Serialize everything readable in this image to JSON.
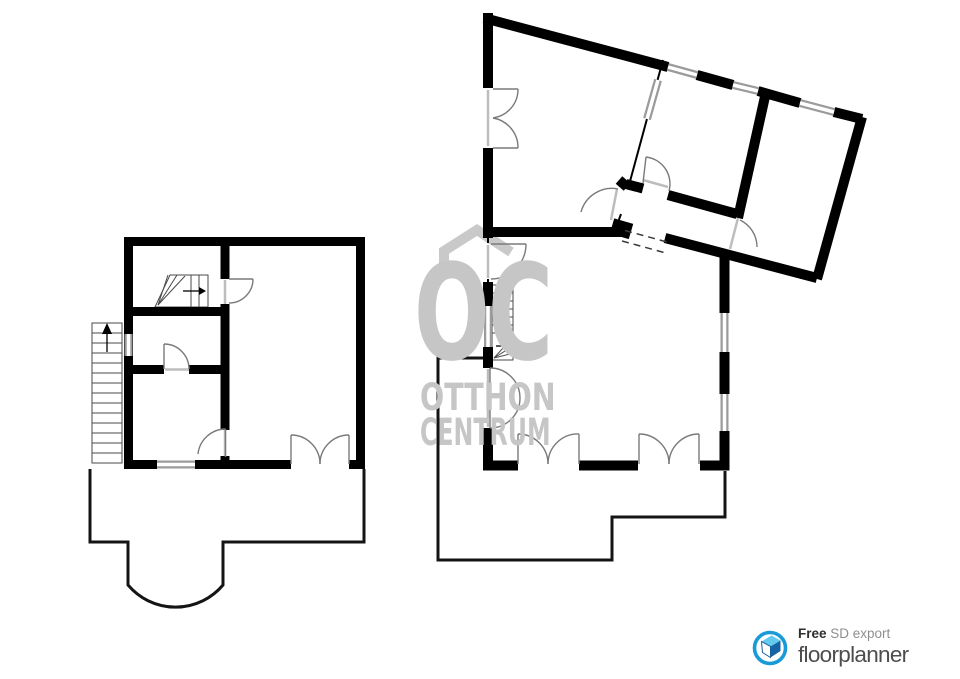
{
  "watermark": {
    "monogram": "OC",
    "line1": "OTTHON",
    "line2": "CENTRUM",
    "color": "#c6c6c6"
  },
  "logo": {
    "free_label": "Free",
    "export_label": " SD export",
    "brand_label": "floorplanner",
    "circle_color": "#1b9ad8",
    "roof_color": "#62c9ef",
    "side_color": "#1463a5"
  },
  "colors": {
    "wall": "#000000",
    "window_frame": "#9b9b9b",
    "window_core": "#ffffff",
    "door": "#7a7a7a",
    "threshold": "#bdbdbd",
    "porch": "#141414",
    "stair": "#4a4a4a",
    "watermark": "#c9c9c9"
  },
  "floorplan": {
    "width": 960,
    "height": 679,
    "layers": [
      {
        "name": "watermark-roof-icon",
        "stroke": "#c9c9c9",
        "width": 10,
        "fill": "none",
        "join": "miter",
        "paths": [
          "M444,263 V251 L477,230 L511,252"
        ]
      },
      {
        "name": "thin-walls",
        "stroke": "#000000",
        "width": 2,
        "fill": "none",
        "paths": [
          "M663,60 L629,185",
          "M621,214 L617,225",
          "M488,238 V243",
          "M488,279 V368",
          "M488,428 V470"
        ]
      },
      {
        "name": "stairs",
        "stroke": "#4a4a4a",
        "width": 1,
        "fill": "none",
        "paths": [
          "M92,323 H122 V463 H92 Z",
          "M92,333 H122",
          "M92,343 H122",
          "M92,353 H122",
          "M92,363 H122",
          "M92,373 H122",
          "M92,383 H122",
          "M92,393 H122",
          "M92,403 H122",
          "M92,413 H122",
          "M92,423 H122",
          "M92,433 H122",
          "M92,443 H122",
          "M92,453 H122",
          "M170,275 L208,275 L208,307 L155,307 Z",
          "M191,275 V307",
          "M199,275 V307",
          "M158,305 L168,275",
          "M158,305 L177,275",
          "M158,305 L185,276",
          "M492,285 H513 V360 H492 Z",
          "M492,293 H513",
          "M492,301 H513",
          "M492,309 H513",
          "M492,317 H513",
          "M492,325 H513",
          "M492,333 H513",
          "M494,358 L513,337",
          "M494,358 L513,346",
          "M494,358 L510,354"
        ]
      },
      {
        "name": "walls-left-plan",
        "stroke": "#000000",
        "width": 9,
        "fill": "none",
        "paths": [
          "M124,241.5 H365",
          "M124,464.5 H157",
          "M195,464.5 H291",
          "M349,464.5 H365",
          "M128.5,237 V469",
          "M360.5,237 V469",
          "M225,246 V279",
          "M225,304 V430",
          "M225,456 V461",
          "M133,311.5 H221",
          "M133,369.5 H164",
          "M189,369.5 H221"
        ]
      },
      {
        "name": "walls-right-plan",
        "stroke": "#000000",
        "width": 10,
        "fill": "none",
        "paths": [
          "M488,13 V88",
          "M488,148 V238",
          "M484,18 L668,67",
          "M697,75 L733,85",
          "M758,91 L800,103",
          "M834,112 L862,119",
          "M862,117 L817,279",
          "M817,278 L665,238",
          "M483,232 H625",
          "M483,465.5 H518",
          "M579,465.5 H638",
          "M700,465.5 H729.5",
          "M724.5,253 V313",
          "M724.5,352 V394",
          "M724.5,431 V470",
          "M488,282 V306",
          "M488,347 V368",
          "M488,428 V470",
          "M766,92 L738,218",
          "M626,184 L643,188.5",
          "M668,195 L737,214",
          "M619,180 L627,187"
        ]
      },
      {
        "name": "wall-corner-block",
        "stroke": "#000000",
        "width": 16,
        "fill": "none",
        "paths": [
          "M612,226 L631,231.5"
        ]
      },
      {
        "name": "window-frames",
        "stroke": "#9b9b9b",
        "width": 8,
        "fill": "none",
        "paths": [
          "M128.5,334 V356",
          "M157,464.5 H195",
          "M668,67 L697,75",
          "M733,85 L758,91",
          "M800,103 L834,112",
          "M658,80 L647,119",
          "M724.5,313 V352",
          "M724.5,394 V431",
          "M488,306 V347"
        ]
      },
      {
        "name": "window-cores",
        "stroke": "#ffffff",
        "width": 3.5,
        "fill": "none",
        "paths": [
          "M128.5,334 V356",
          "M157,464.5 H195",
          "M668,67 L697,75",
          "M733,85 L758,91",
          "M800,103 L834,112",
          "M658,80 L647,119",
          "M724.5,313 V352",
          "M724.5,394 V431",
          "M488,306 V347"
        ]
      },
      {
        "name": "door-thresholds",
        "stroke": "#bdbdbd",
        "width": 2.5,
        "fill": "none",
        "paths": [
          "M488,90 V146",
          "M488,245 V278",
          "M488,369 V427",
          "M225,280 V304",
          "M225,430 V456",
          "M165,369.5 H189",
          "M643,180 L668,187",
          "M738,218 L730,249",
          "M617,189 L611,220"
        ]
      },
      {
        "name": "open-passage-dashed",
        "stroke": "#3a3a3a",
        "width": 1.5,
        "fill": "none",
        "dash": "7,5",
        "paths": [
          "M625,230.5 L667,242",
          "M622,241 L664,252.5"
        ]
      },
      {
        "name": "porch-outlines",
        "stroke": "#141414",
        "width": 3,
        "fill": "none",
        "paths": [
          "M90,469 V542 H128 V585 A62,62 0 0 0 223,585 V542 H364 V469",
          "M483,358 H438 V560 H612 V517 H725 V471"
        ]
      },
      {
        "name": "doors",
        "stroke": "#7a7a7a",
        "width": 1.4,
        "fill": "none",
        "paths": [
          "M229,279 H253",
          "M253,279 A24,24 0 0 1 229,303",
          "M225.5,429 V457",
          "M225.5,429 A28,28 0 0 0 198,454",
          "M164,369 V344",
          "M164,344 A25,25 0 0 1 189,369",
          "M291,464 V435",
          "M349,464 V435",
          "M291,435 A29,29 0 0 1 320,464",
          "M349,435 A29,29 0 0 0 320,464",
          "M493,89 H518",
          "M493,148 H518",
          "M518,89 A29,29 0 0 1 493,118",
          "M493,118 A30,30 0 0 1 518,148",
          "M491,244 H526",
          "M526,244 A35,35 0 0 1 491,279",
          "M490,368 V428",
          "M490,368 A30,30 0 0 1 520,398",
          "M520,398 A30,30 0 0 1 490,428",
          "M646,157 L643,183",
          "M646,157 A27,27 0 0 1 669,191",
          "M740,220 A30,30 0 0 1 757,247",
          "M618,189 A32,32 0 0 0 581,212",
          "M518,464 V434",
          "M579,464 V434",
          "M518,434 A30,30 0 0 1 548,464",
          "M579,434 A30,30 0 0 0 548,464",
          "M639,464 V434",
          "M699,464 V434",
          "M639,434 A30,30 0 0 1 669,464",
          "M699,434 A30,30 0 0 0 669,464"
        ]
      },
      {
        "name": "stair-arrow-shafts",
        "stroke": "#000000",
        "width": 1.3,
        "fill": "none",
        "paths": [
          "M183,291 H199",
          "M496,346 H505",
          "M107,332 V352"
        ]
      },
      {
        "name": "stair-arrow-heads-icon",
        "stroke": "none",
        "width": 0,
        "fill": "#000000",
        "polys": [
          "199,287 206,291 199,295",
          "505,342 512,346 505,350",
          "102,334 107,323 112,334"
        ]
      },
      {
        "name": "floorplanner-logo-circle-icon",
        "stroke": "#1b9ad8",
        "width": 3.6,
        "fill": "#ffffff",
        "paths": [
          "M754.5,648 A15.5,15.5 0 1 0 785.5,648 A15.5,15.5 0 1 0 754.5,648 Z"
        ]
      },
      {
        "name": "floorplanner-logo-house-icon",
        "stroke": "none",
        "width": 0,
        "fill": "#62c9ef",
        "polys": [
          "761.5,641.5 771.5,635.5 780.5,640.5 770.5,646.5"
        ]
      },
      {
        "name": "floorplanner-logo-house-side-icon",
        "stroke": "none",
        "width": 0,
        "fill": "#1463a5",
        "polys": [
          "770.5,646.5 780.5,640.5 780.5,651 770.5,657.5",
          "765.5,647.5 769,649.8 769,655.5 765.5,653"
        ]
      },
      {
        "name": "floorplanner-logo-house-front-icon",
        "stroke": "#1a5f9e",
        "width": 1,
        "fill": "#ffffff",
        "polys": [
          "761.5,641.5 770.5,646.5 770.5,657.5 762.5,652.5"
        ]
      }
    ]
  }
}
